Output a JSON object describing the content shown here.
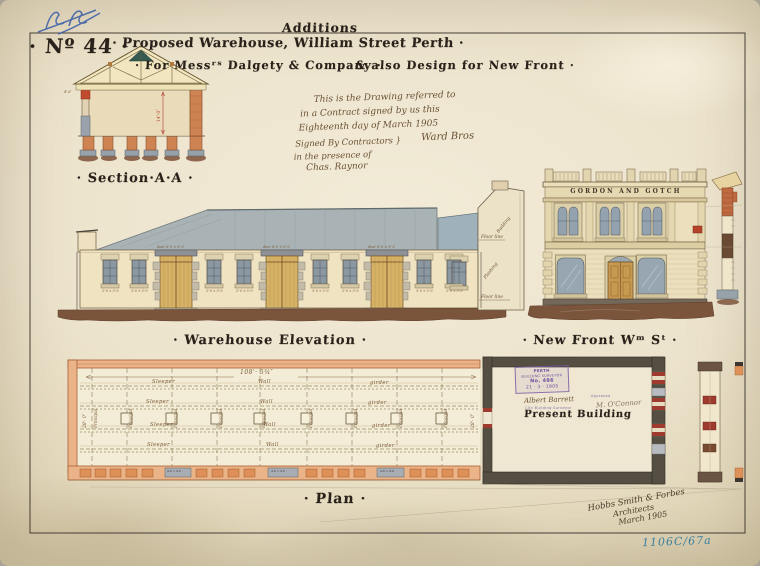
{
  "sheet": {
    "number_label": "· Nº 44 ·",
    "title_small": "Additions",
    "title_main": "· Proposed Warehouse, William Street Perth ·",
    "title_sub_left": "· For Messʳˢ Dalgety & Company ·",
    "title_sub_right": "& also Design for New Front ·",
    "catalog_ref": "1106C/67a"
  },
  "section": {
    "label": "· Section·A·A ·",
    "height_dim": "14'·0″",
    "eave_note": "4'·6″"
  },
  "contract_note": {
    "line1": "This is the Drawing referred to",
    "line2": "in a Contract signed by us this",
    "line3": "Eighteenth day of March 1905",
    "line4a": "Signed By Contractors }",
    "line4b": "Ward Bros",
    "line5": "in the presence of",
    "line6": "Chas. Raynor"
  },
  "elevation": {
    "label": "· Warehouse Elevation ·",
    "building_note": "Building",
    "floor_line_note": "Floor   line",
    "flashing_note": "Flashing",
    "window_note": "3'·0 × 5'·0",
    "door_note": "door 6'·0 × 9'·0"
  },
  "new_front": {
    "label": "· New Front Wᵐ Sᵗ ·",
    "frieze_text": "GORDON AND GOTCH"
  },
  "plan": {
    "label": "· Plan ·",
    "length_dim": "108'· 5¾″",
    "width_dim": "28'· 0″",
    "sleeper_label": "Sleeper",
    "wall_label": "Wall",
    "girder_label": "girder",
    "principal_label": "Principal",
    "present_building_label": "Present Building",
    "door_lintel_note": "4·6 × 9·0",
    "stamp": {
      "line1": "PERTH",
      "line2": "BUILDING SURVEYOR",
      "line3": "No. 486",
      "line4": "21 · 3 · 1905"
    },
    "surveyor_signature": "Albert Barrett",
    "surveyor_title": "City Building Surveyor",
    "approval_note": "Approved",
    "second_signature": "M. O'Connor"
  },
  "architect_note": {
    "line1": "Hobbs Smith & Forbes",
    "line2": "Architects",
    "line3": "March 1905"
  }
}
